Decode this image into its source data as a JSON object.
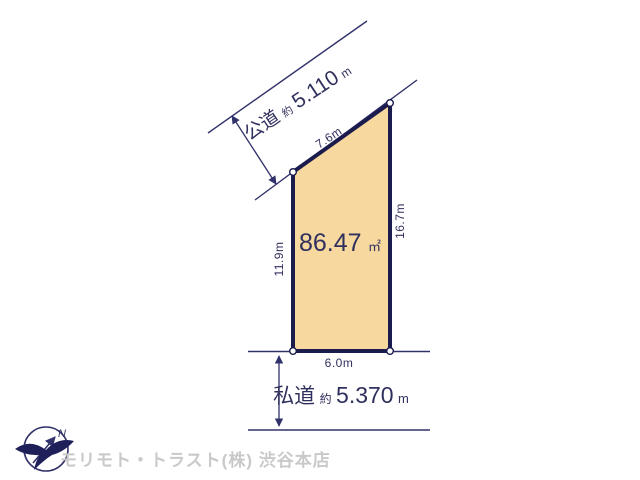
{
  "diagram": {
    "plot": {
      "area_value": "86.47",
      "area_unit": "㎡",
      "dimensions": {
        "top": "7.6m",
        "right": "16.7m",
        "left": "11.9m",
        "bottom": "6.0m"
      }
    },
    "roads": {
      "public": {
        "name": "公道",
        "approx_prefix": "約",
        "width_value": "5.110",
        "unit": "m"
      },
      "private": {
        "name": "私道",
        "approx_prefix": "約",
        "width_value": "5.370",
        "unit": "m"
      }
    },
    "compass": {
      "north_label": "N"
    },
    "colors": {
      "plot_fill": "#f7d89e",
      "plot_border": "#1b1b4e",
      "line": "#32326b",
      "label_text": "#30305e",
      "watermark_text": "#c9c9c9"
    }
  },
  "footer": {
    "company_watermark": "モリモト・トラスト(株) 渋谷本店"
  }
}
